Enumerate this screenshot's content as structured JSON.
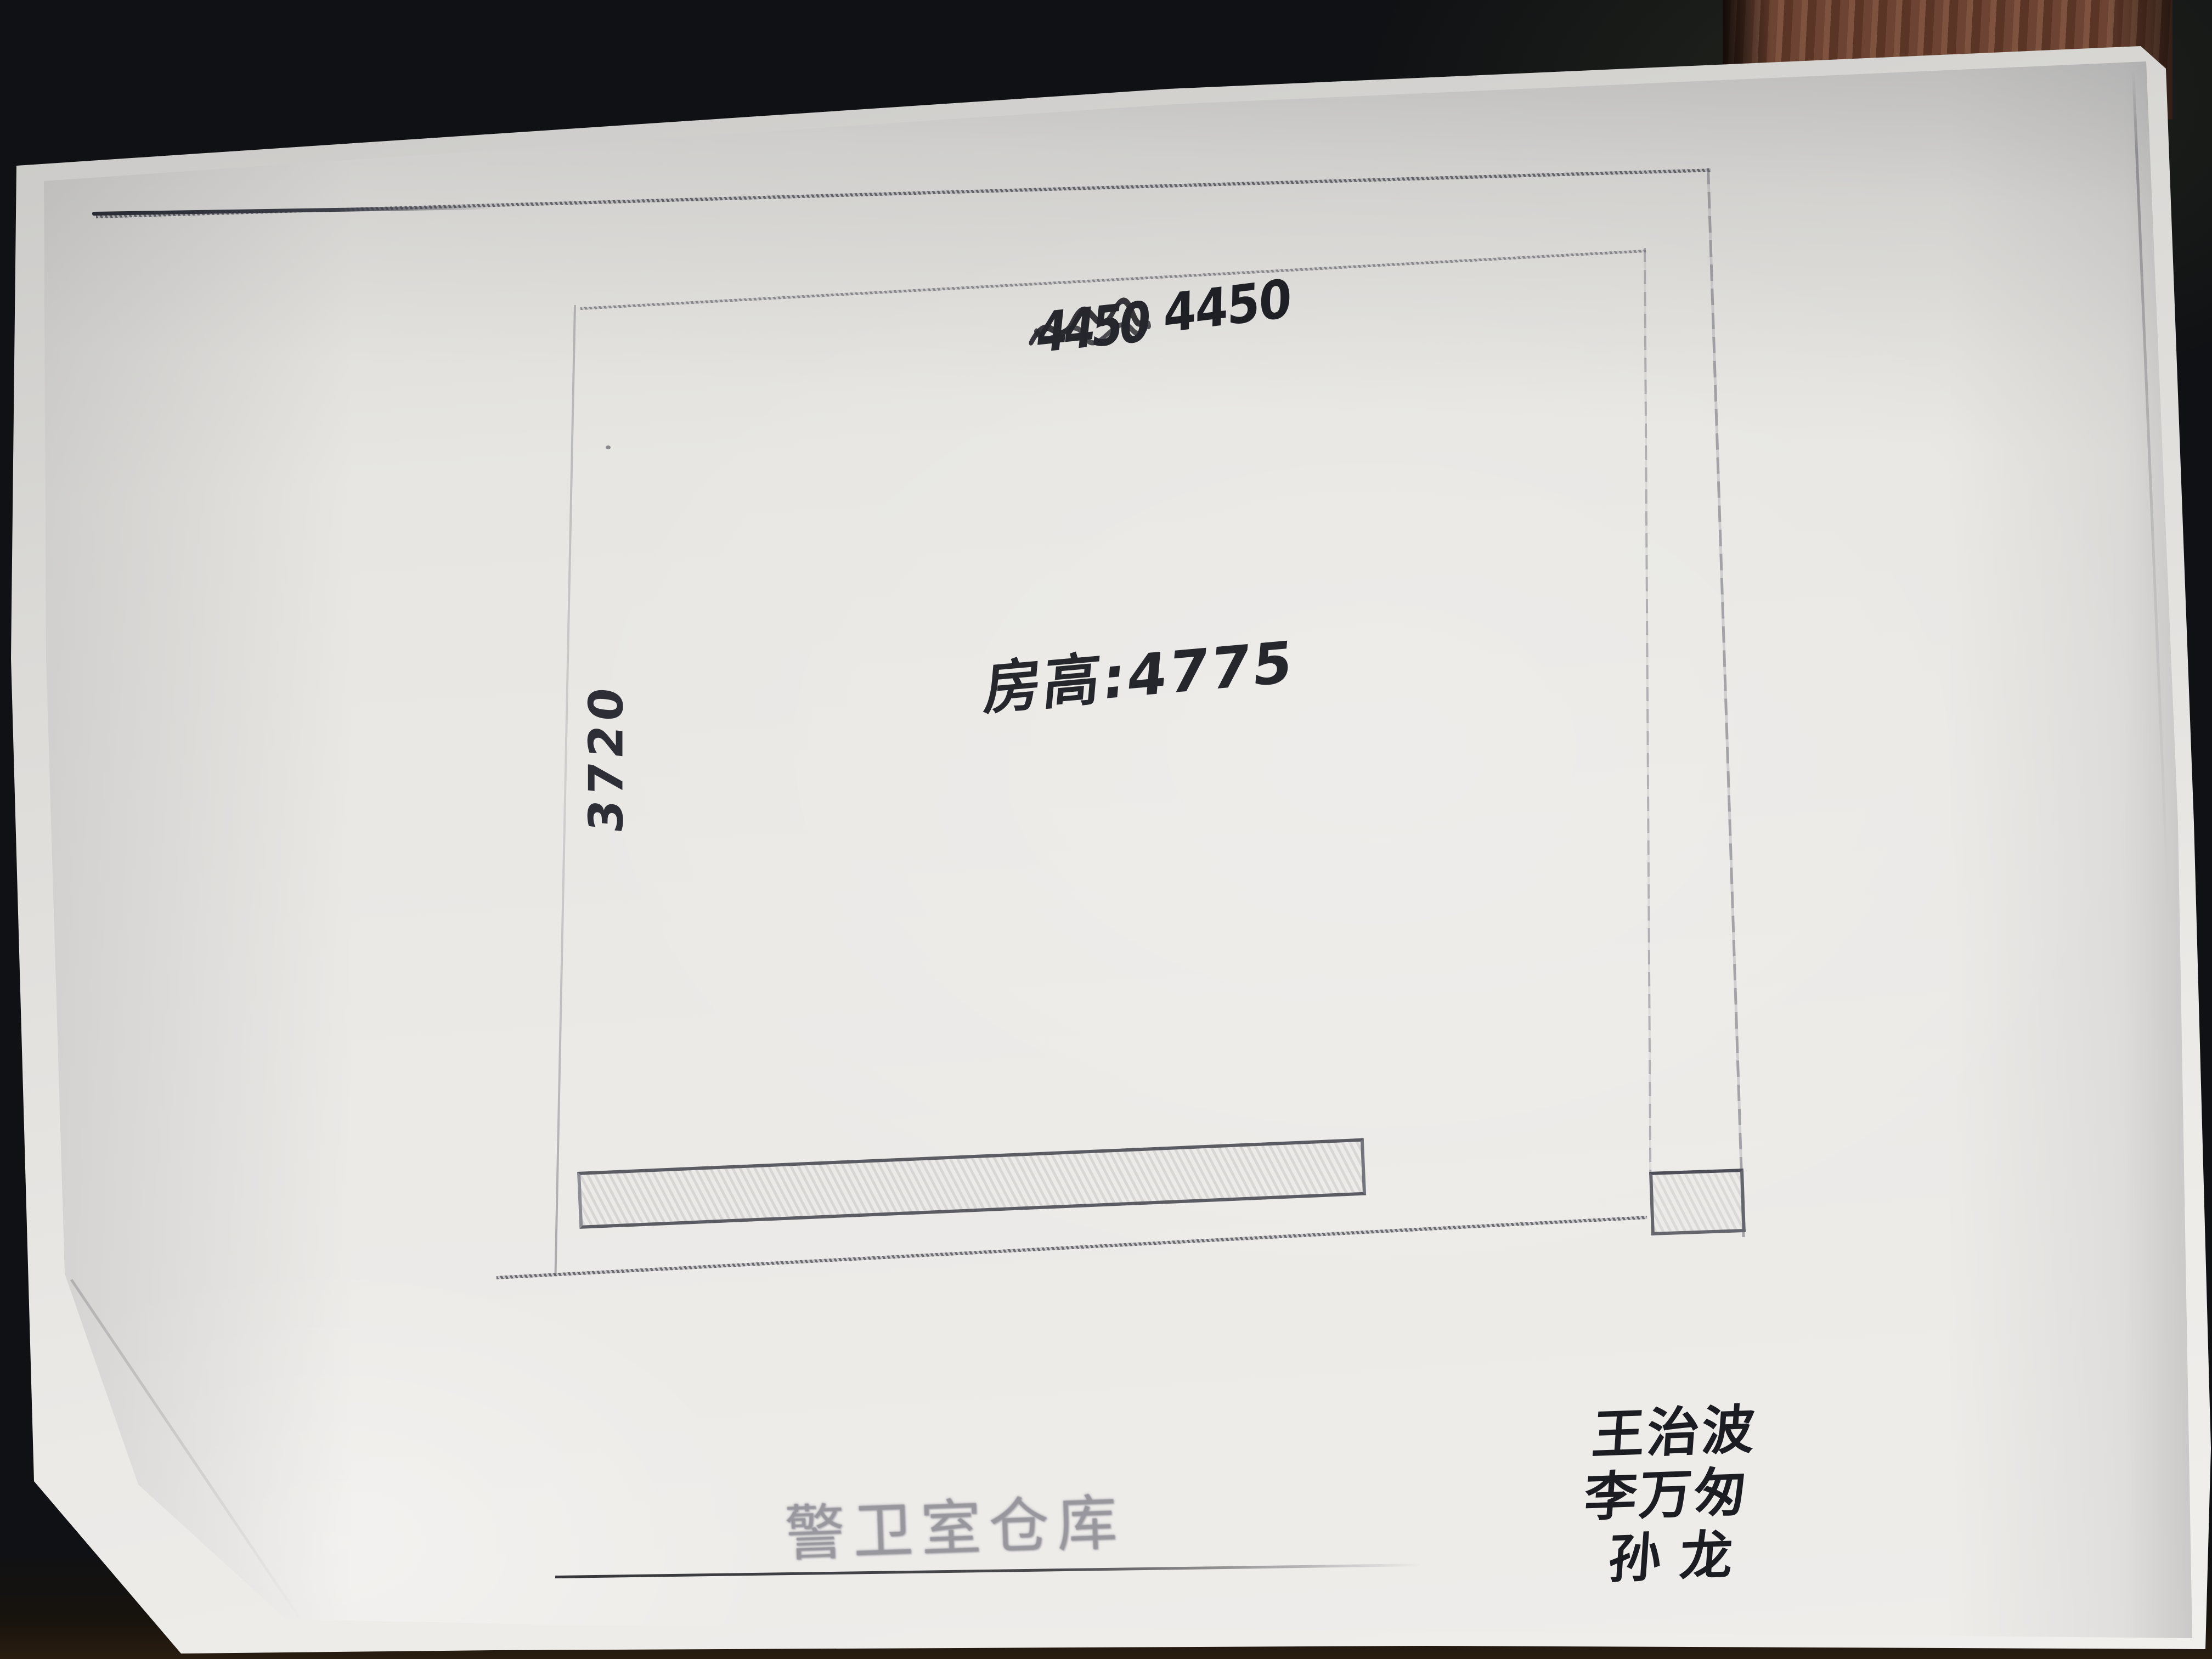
{
  "scene": {
    "desk_color": "#101114",
    "wood_edge_color": "#6d4433",
    "paper_color": "#e9e8e4",
    "ink_color": "#23242b",
    "print_line_color": "#6a6a74"
  },
  "floor_plan": {
    "dim_top_crossed_out": "4450",
    "dim_top": "4450",
    "dim_left": "3720",
    "room_height_note": "房高:4775",
    "caption": "警卫室仓库",
    "signatures": [
      "王治波",
      "李万匆",
      "孙龙"
    ]
  }
}
